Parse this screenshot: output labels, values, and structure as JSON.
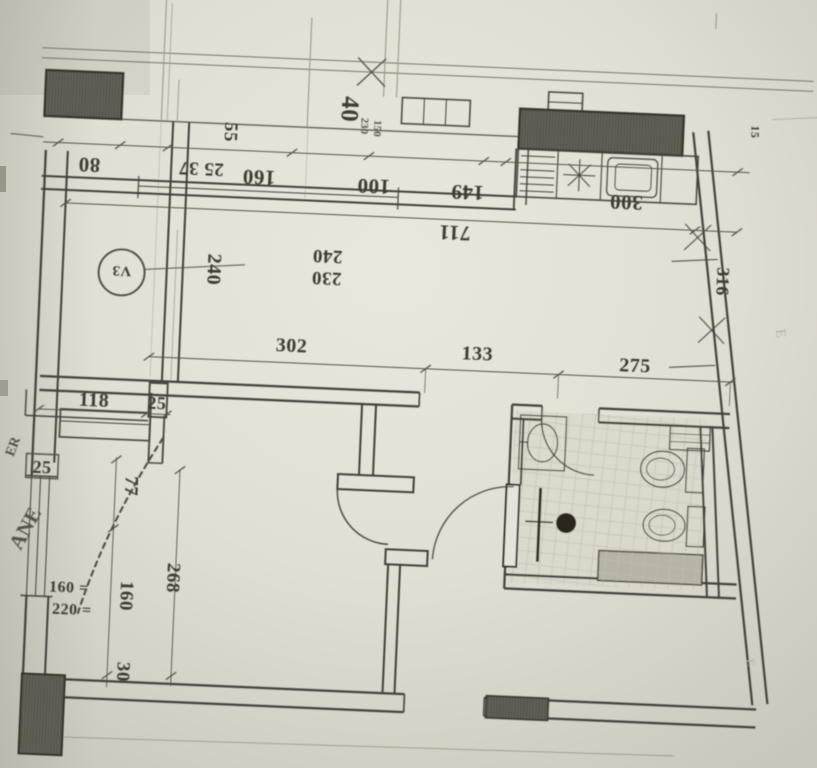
{
  "document": {
    "kind": "architectural floor plan (photographed, drawing rotated 180°)",
    "units": "cm"
  },
  "colors": {
    "paper_light": "#e9e6dc",
    "paper_mid": "#dfdcd2",
    "paper_dark": "#c9c6bc",
    "ink": "#43403a",
    "pencil": "#8d8a7e",
    "wall_fill": "#5c5950"
  },
  "labels": {
    "d80": "80",
    "d2537": "25 37",
    "d160": "160",
    "d100": "100",
    "d149": "149",
    "d300": "300",
    "d711": "711",
    "d55": "55",
    "d40": "40",
    "d230tiny": "230",
    "d150tiny": "150",
    "d240v": "240",
    "d240": "240",
    "d230": "230",
    "vent_circle": "V3",
    "d316": "316",
    "d15": "15",
    "d302": "302",
    "d133": "133",
    "d275": "275",
    "d118": "118",
    "d25a": "25",
    "d25b": "25",
    "d77": "77",
    "d268": "268",
    "d160v": "160",
    "d30": "30",
    "win_w": "160 =",
    "win_h": "220 =",
    "edge_t1": "ER",
    "edge_t2": "ANE",
    "pencil_m1": "E",
    "pencil_m2": "E"
  }
}
